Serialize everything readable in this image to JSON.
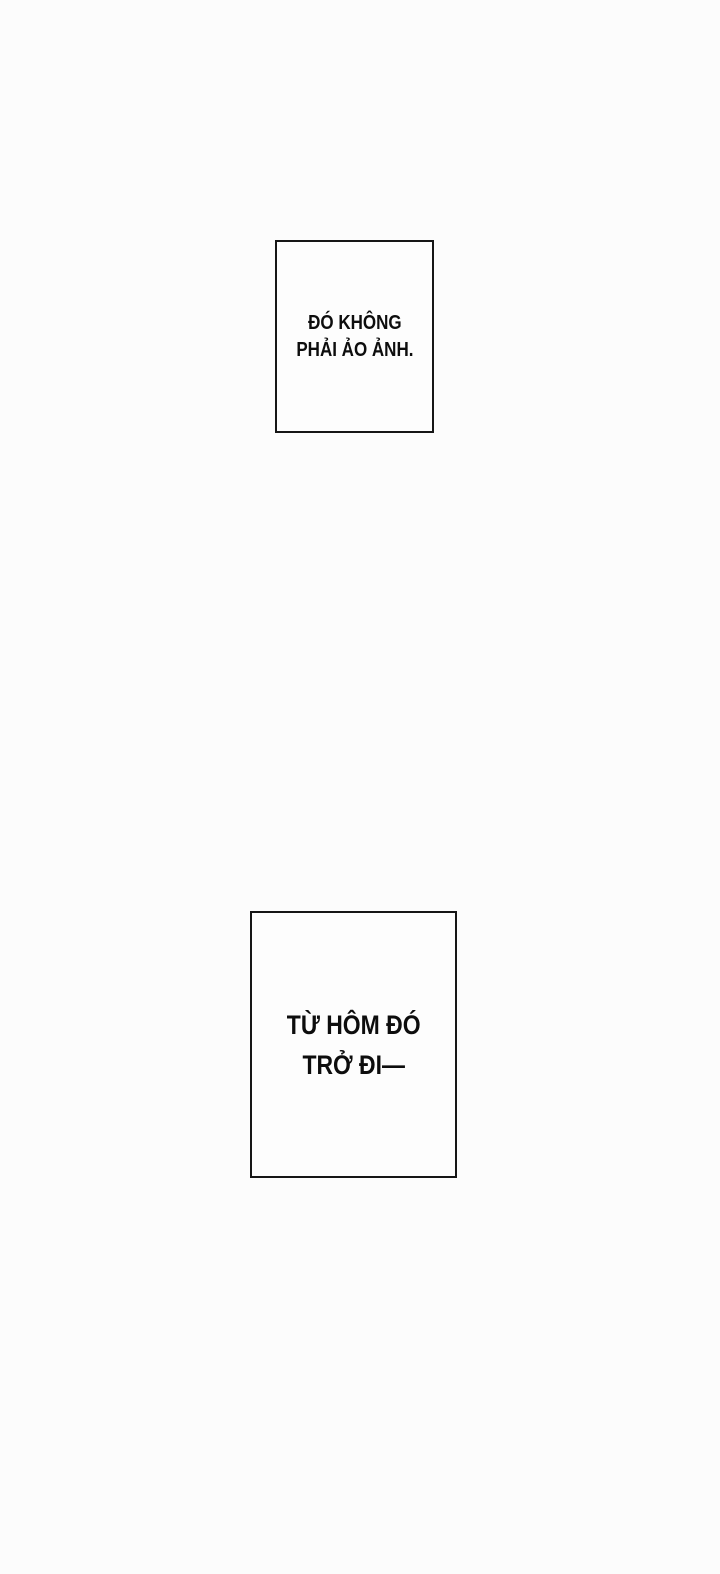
{
  "page": {
    "type": "webtoon-comic-page",
    "background_color": "#fcfcfc"
  },
  "captions": [
    {
      "id": "caption-1",
      "full_text": "ĐÓ KHÔNG PHẢI ẢO ẢNH.",
      "lines": [
        "ĐÓ KHÔNG",
        "PHẢI ẢO ẢNH."
      ],
      "border_color": "#161616",
      "fill_color": "#fdfdfd",
      "text_color": "#0d0d0d"
    },
    {
      "id": "caption-2",
      "full_text": "TỪ HÔM ĐÓ TRỞ ĐI—",
      "lines": [
        "TỪ HÔM ĐÓ",
        "TRỞ ĐI—"
      ],
      "border_color": "#161616",
      "fill_color": "#fdfdfd",
      "text_color": "#0d0d0d"
    }
  ]
}
